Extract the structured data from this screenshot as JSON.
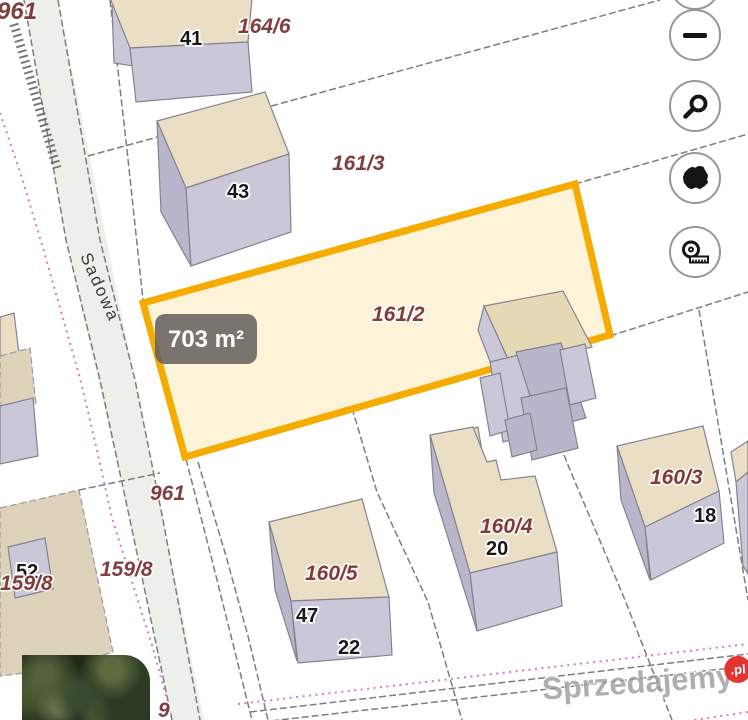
{
  "map": {
    "street": "Sadowa",
    "area_badge": "703 m²",
    "parcels": {
      "p961_top": "961",
      "p164_6": "164/6",
      "p161_3": "161/3",
      "p161_2": "161/2",
      "p961_mid": "961",
      "p159_8_a": "159/8",
      "p159_8_b": "159/8",
      "p160_5": "160/5",
      "p160_4": "160/4",
      "p160_3": "160/3",
      "p_partial_bottom": "9"
    },
    "houses": {
      "h41": "41",
      "h43": "43",
      "h52": "52",
      "h47": "47",
      "h22": "22",
      "h20": "20",
      "h18": "18"
    },
    "colors": {
      "highlight_border": "#f5ab00",
      "highlight_fill": "#fcf3d8",
      "roof": "#eadfc5",
      "wall": "#cac7d9",
      "parcel_label": "#7b3434",
      "badge_bg": "#68625f",
      "road_fill": "#edf0ea",
      "pink_boundary": "#dd74c4"
    }
  },
  "controls": {
    "buttons": [
      {
        "name": "zoom-out",
        "icon": "minus-icon"
      },
      {
        "name": "search",
        "icon": "magnifier-icon"
      },
      {
        "name": "poland-extent",
        "icon": "poland-map-icon"
      },
      {
        "name": "measure",
        "icon": "measuring-tape-icon"
      }
    ]
  },
  "watermark": {
    "brand": "Sprzedajemy",
    "tld": ".pl",
    "badge_color": "#e3342f"
  }
}
